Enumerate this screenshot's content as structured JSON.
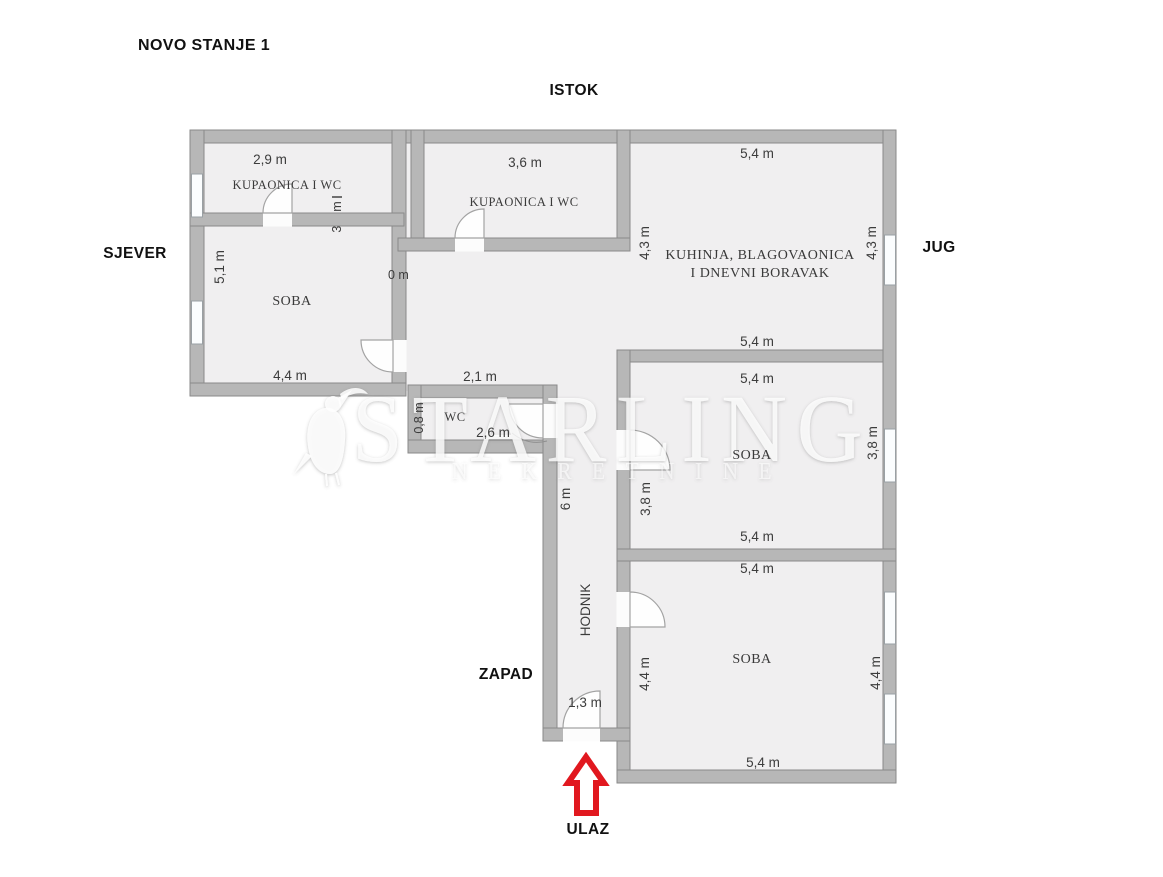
{
  "title": "NOVO STANJE 1",
  "compass": {
    "top": "ISTOK",
    "left": "SJEVER",
    "right": "JUG",
    "bottom": "ZAPAD"
  },
  "entrance": {
    "label": "ULAZ"
  },
  "watermark": {
    "brand": "STARLING",
    "subtitle": "NEKRETNINE",
    "icon": "starling-bird"
  },
  "rooms": {
    "bathroom1": {
      "name": "KUPAONICA I WC",
      "width": "2,9 m",
      "clipped_dim": "3,1 m"
    },
    "bathroom2": {
      "name": "KUPAONICA I WC",
      "width": "3,6 m"
    },
    "kitchen": {
      "name_line1": "KUHINJA, BLAGOVAONICA",
      "name_line2": "I DNEVNI BORAVAK",
      "top": "5,4 m",
      "bottom": "5,4 m",
      "left": "4,3 m",
      "right": "4,3 m"
    },
    "soba1": {
      "name": "SOBA",
      "left": "5,1 m",
      "bottom": "4,4 m"
    },
    "corridor": {
      "width": "2,1 m",
      "clipped_fragment": "0 m"
    },
    "wc": {
      "name": "WC",
      "height": "0,8 m",
      "width": "2,6 m"
    },
    "hallway": {
      "name": "HODNIK",
      "length": "6 m",
      "door_width": "1,3 m"
    },
    "soba2": {
      "name": "SOBA",
      "top": "5,4 m",
      "bottom": "5,4 m",
      "left": "3,8 m",
      "right": "3,8 m"
    },
    "soba3": {
      "name": "SOBA",
      "top": "5,4 m",
      "bottom": "5,4 m",
      "left": "4,4 m",
      "right": "4,4 m"
    }
  },
  "colors": {
    "floor": "#f0eff0",
    "wall": "#b7b7b7",
    "wall_edge": "#8a8a8a",
    "arrow_red": "#e1181f",
    "text": "#3c3c3c",
    "heading": "#111111"
  }
}
